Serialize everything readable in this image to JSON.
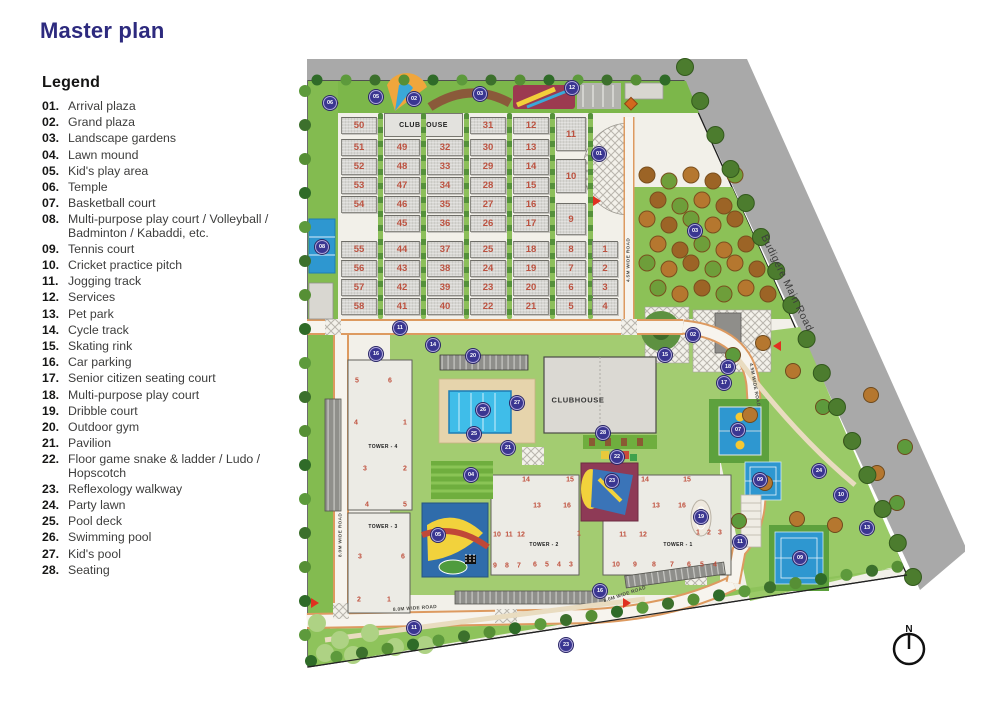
{
  "title": "Master plan",
  "legend": {
    "heading": "Legend",
    "items": [
      {
        "num": "01.",
        "text": "Arrival plaza"
      },
      {
        "num": "02.",
        "text": "Grand plaza"
      },
      {
        "num": "03.",
        "text": "Landscape gardens"
      },
      {
        "num": "04.",
        "text": "Lawn mound"
      },
      {
        "num": "05.",
        "text": "Kid's play area"
      },
      {
        "num": "06.",
        "text": "Temple"
      },
      {
        "num": "07.",
        "text": "Basketball court"
      },
      {
        "num": "08.",
        "text": "Multi-purpose play court / Volleyball / Badminton / Kabaddi, etc."
      },
      {
        "num": "09.",
        "text": "Tennis court"
      },
      {
        "num": "10.",
        "text": "Cricket practice pitch"
      },
      {
        "num": "11.",
        "text": "Jogging track"
      },
      {
        "num": "12.",
        "text": "Services"
      },
      {
        "num": "13.",
        "text": "Pet park"
      },
      {
        "num": "14.",
        "text": "Cycle track"
      },
      {
        "num": "15.",
        "text": "Skating rink"
      },
      {
        "num": "16.",
        "text": "Car parking"
      },
      {
        "num": "17.",
        "text": "Senior citizen seating court"
      },
      {
        "num": "18.",
        "text": "Multi-purpose play court"
      },
      {
        "num": "19.",
        "text": "Dribble court"
      },
      {
        "num": "20.",
        "text": "Outdoor gym"
      },
      {
        "num": "21.",
        "text": "Pavilion"
      },
      {
        "num": "22.",
        "text": "Floor game snake & ladder / Ludo / Hopscotch"
      },
      {
        "num": "23.",
        "text": "Reflexology walkway"
      },
      {
        "num": "24.",
        "text": "Party lawn"
      },
      {
        "num": "25.",
        "text": "Pool deck"
      },
      {
        "num": "26.",
        "text": "Swimming pool"
      },
      {
        "num": "27.",
        "text": "Kid's pool"
      },
      {
        "num": "28.",
        "text": "Seating"
      }
    ]
  },
  "plan": {
    "main_road": {
      "label": "Budigere Main Road"
    },
    "compass": {
      "label": "N"
    },
    "plots": {
      "clubhouse_label": "CLUBHOUSE",
      "columns": [
        {
          "x": 46,
          "w": 36,
          "cells": [
            [
              "50",
              62
            ],
            [
              "51",
              84
            ],
            [
              "52",
              103
            ],
            [
              "53",
              122
            ],
            [
              "54",
              141
            ],
            [
              "55",
              186
            ],
            [
              "56",
              205
            ],
            [
              "57",
              224
            ],
            [
              "58",
              243
            ]
          ]
        },
        {
          "x": 89,
          "w": 36,
          "cells": [
            [
              "49",
              84
            ],
            [
              "48",
              103
            ],
            [
              "47",
              122
            ],
            [
              "46",
              141
            ],
            [
              "45",
              160
            ],
            [
              "44",
              186
            ],
            [
              "43",
              205
            ],
            [
              "42",
              224
            ],
            [
              "41",
              243
            ]
          ]
        },
        {
          "x": 132,
          "w": 36,
          "cells": [
            [
              "32",
              84
            ],
            [
              "33",
              103
            ],
            [
              "34",
              122
            ],
            [
              "35",
              141
            ],
            [
              "36",
              160
            ],
            [
              "37",
              186
            ],
            [
              "38",
              205
            ],
            [
              "39",
              224
            ],
            [
              "40",
              243
            ]
          ]
        },
        {
          "x": 175,
          "w": 36,
          "cells": [
            [
              "31",
              62
            ],
            [
              "30",
              84
            ],
            [
              "29",
              103
            ],
            [
              "28",
              122
            ],
            [
              "27",
              141
            ],
            [
              "26",
              160
            ],
            [
              "25",
              186
            ],
            [
              "24",
              205
            ],
            [
              "23",
              224
            ],
            [
              "22",
              243
            ]
          ]
        },
        {
          "x": 218,
          "w": 36,
          "cells": [
            [
              "12",
              62
            ],
            [
              "13",
              84
            ],
            [
              "14",
              103
            ],
            [
              "15",
              122
            ],
            [
              "16",
              141
            ],
            [
              "17",
              160
            ],
            [
              "18",
              186
            ],
            [
              "19",
              205
            ],
            [
              "20",
              224
            ],
            [
              "21",
              243
            ]
          ]
        },
        {
          "x": 261,
          "w": 30,
          "cells": [
            [
              "11",
              62,
              34
            ],
            [
              "10",
              104,
              34
            ],
            [
              "9",
              148,
              32
            ],
            [
              "8",
              186
            ],
            [
              "7",
              205
            ],
            [
              "6",
              224
            ],
            [
              "5",
              243
            ]
          ]
        },
        {
          "x": 297,
          "w": 26,
          "cells": [
            [
              "1",
              186
            ],
            [
              "2",
              205
            ],
            [
              "3",
              224
            ],
            [
              "4",
              243
            ]
          ]
        }
      ]
    },
    "clubhouse_building": {
      "label": "CLUBHOUSE"
    },
    "towers": [
      {
        "label": "TOWER - 4",
        "x": 53,
        "y": 305,
        "w": 64,
        "h": 150,
        "lx": 88,
        "ly": 392,
        "units": [
          [
            "5",
            62,
            326
          ],
          [
            "6",
            95,
            326
          ],
          [
            "4",
            61,
            368
          ],
          [
            "1",
            110,
            368
          ],
          [
            "3",
            70,
            414
          ],
          [
            "2",
            110,
            414
          ],
          [
            "4",
            72,
            450
          ],
          [
            "5",
            110,
            450
          ]
        ]
      },
      {
        "label": "TOWER - 3",
        "x": 53,
        "y": 458,
        "w": 62,
        "h": 100,
        "lx": 88,
        "ly": 472,
        "units": [
          [
            "3",
            65,
            502
          ],
          [
            "6",
            108,
            502
          ],
          [
            "2",
            64,
            545
          ],
          [
            "1",
            94,
            545
          ]
        ]
      },
      {
        "label": "TOWER - 2",
        "x": 196,
        "y": 420,
        "w": 88,
        "h": 100,
        "lx": 249,
        "ly": 490,
        "units": [
          [
            "14",
            231,
            425
          ],
          [
            "15",
            275,
            425
          ],
          [
            "13",
            242,
            451
          ],
          [
            "16",
            272,
            451
          ],
          [
            "10",
            202,
            480
          ],
          [
            "11",
            214,
            480
          ],
          [
            "12",
            226,
            480
          ],
          [
            "1",
            284,
            479
          ],
          [
            "9",
            200,
            511
          ],
          [
            "8",
            212,
            511
          ],
          [
            "7",
            224,
            511
          ],
          [
            "6",
            240,
            510
          ],
          [
            "5",
            252,
            510
          ],
          [
            "4",
            264,
            510
          ],
          [
            "3",
            276,
            510
          ]
        ]
      },
      {
        "label": "TOWER - 1",
        "x": 308,
        "y": 420,
        "w": 128,
        "h": 100,
        "lx": 383,
        "ly": 490,
        "units": [
          [
            "14",
            350,
            425
          ],
          [
            "15",
            392,
            425
          ],
          [
            "13",
            361,
            451
          ],
          [
            "16",
            387,
            451
          ],
          [
            "11",
            328,
            480
          ],
          [
            "12",
            348,
            480
          ],
          [
            "1",
            403,
            478
          ],
          [
            "2",
            414,
            478
          ],
          [
            "3",
            425,
            478
          ],
          [
            "10",
            321,
            510
          ],
          [
            "9",
            340,
            510
          ],
          [
            "8",
            359,
            510
          ],
          [
            "7",
            377,
            510
          ],
          [
            "6",
            394,
            510
          ],
          [
            "5",
            407,
            510
          ],
          [
            "4",
            420,
            510
          ]
        ]
      }
    ],
    "road_labels": [
      {
        "t": "8.0M WIDE ROAD",
        "x": 46,
        "y": 480,
        "r": -90
      },
      {
        "t": "8.0M WIDE ROAD",
        "x": 120,
        "y": 554,
        "r": -4
      },
      {
        "t": "8.0M WIDE ROAD",
        "x": 330,
        "y": 540,
        "r": -18
      },
      {
        "t": "4.5M WIDE ROAD",
        "x": 334,
        "y": 205,
        "r": -90
      },
      {
        "t": "4.5M WIDE ROAD",
        "x": 459,
        "y": 330,
        "r": 80
      }
    ],
    "markers": [
      [
        "05",
        81,
        42
      ],
      [
        "02",
        119,
        44
      ],
      [
        "06",
        35,
        48
      ],
      [
        "03",
        185,
        39
      ],
      [
        "12",
        277,
        33
      ],
      [
        "01",
        304,
        99
      ],
      [
        "03",
        400,
        176
      ],
      [
        "11",
        105,
        273
      ],
      [
        "14",
        138,
        290
      ],
      [
        "16",
        81,
        299
      ],
      [
        "20",
        178,
        301
      ],
      [
        "08",
        27,
        192
      ],
      [
        "26",
        188,
        355
      ],
      [
        "27",
        222,
        348
      ],
      [
        "25",
        179,
        379
      ],
      [
        "04",
        176,
        420
      ],
      [
        "05",
        143,
        480
      ],
      [
        "21",
        213,
        393
      ],
      [
        "28",
        308,
        378
      ],
      [
        "22",
        322,
        402
      ],
      [
        "23",
        317,
        426
      ],
      [
        "19",
        406,
        462
      ],
      [
        "02",
        398,
        280
      ],
      [
        "17",
        429,
        328
      ],
      [
        "07",
        443,
        375
      ],
      [
        "09",
        465,
        425
      ],
      [
        "09",
        505,
        503
      ],
      [
        "10",
        546,
        440
      ],
      [
        "13",
        572,
        473
      ],
      [
        "24",
        524,
        416
      ],
      [
        "11",
        445,
        487
      ],
      [
        "11",
        119,
        573
      ],
      [
        "16",
        305,
        536
      ],
      [
        "23",
        271,
        590
      ],
      [
        "15",
        370,
        300
      ],
      [
        "18",
        433,
        312
      ]
    ]
  }
}
